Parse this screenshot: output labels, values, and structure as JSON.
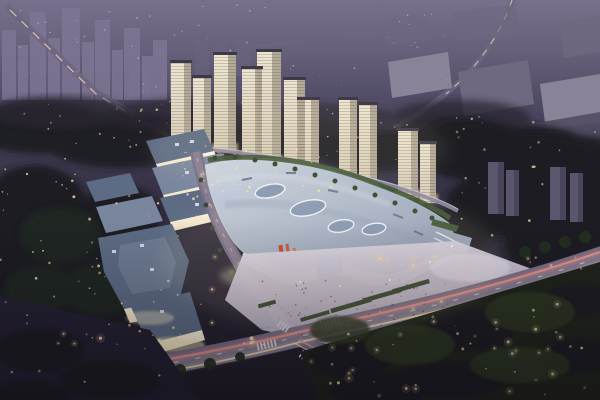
{
  "scene": {
    "description": "Aerial night-time architectural rendering of a mixed-use development: a curved-roof shopping mall with glowing facades and a blue LED media screen, a cluster of eleven illuminated residential high-rise towers behind it, low-rise street retail blocks to the west, a landscaped pedestrian plaza, and a major road intersection with car light trails, all surrounded by dark parkland, scattered warm lights and a hazy dusk city skyline.",
    "time_of_day": "dusk",
    "view": "aerial oblique",
    "lit_tower_count": 11,
    "led_screen_color": "blue"
  },
  "palette": {
    "sky_top": "#5e5873",
    "sky_mid": "#46415a",
    "ground_dark": "#2c2837",
    "ground_bottom": "#201c27",
    "haze": "#9089a6",
    "distant_building": "#7e7694",
    "distant_building_dim": "#6c6582",
    "slab": "#8a8398",
    "slab_dark": "#6e6880",
    "slab_deep": "#524c64",
    "tree_dark": "#1e1a24",
    "tree_mid": "#2a2533",
    "tree_green": "#242e20",
    "park_tree": "#2e3824",
    "lawn": "#242031",
    "park_base": "#20241c",
    "tower_lit": "#efe6d2",
    "tower_lit2": "#d8cdb7",
    "tower_shade": "#b4aa98",
    "tower_cap": "#3e3947",
    "tower_glow": "#ffe2a4",
    "dark_tower": "#5b556e",
    "dark_tower_side": "#4a455c",
    "mall_roof_light": "#cdd6e3",
    "mall_roof": "#a9b5ca",
    "mall_roof_dark": "#8795b0",
    "skylight": "#8496b2",
    "skylight_rim": "#ecf1f8",
    "fascia": "#f7f9fd",
    "facade_bright": "#fdf6e3",
    "facade_warm": "#ecdfc2",
    "glow_warm": "#f9e9c0",
    "retail_roof": "#5d6b84",
    "retail_roof_light": "#79869e",
    "roof_unit": "#cfd6e2",
    "terrace": "#95a2b8",
    "hedge": "#3d5433",
    "planter": "#35462c",
    "tree_dot": "#2f4427",
    "tree_dot_light": "#50693d",
    "led_blue": "#1d55c4",
    "led_blue_light": "#6a9af2",
    "sign_red": "#cc3d28",
    "sign_orange": "#d9772e",
    "road": "#766d86",
    "road_light": "#8f8698",
    "road_minor": "#6e6680",
    "walkway": "#8f87a0",
    "railing": "#d9d4e4",
    "trail_red": "#f0938a",
    "trail_warm": "#f8e3bd",
    "lamp": "#ffd9a0",
    "plaza_light": "#e3ddeb",
    "plaza": "#b6aec3",
    "plaza_bright": "#eae4f1",
    "people": "#433c50",
    "crosswalk": "#d8d2df",
    "window_cool": "#d8cfe8",
    "entry_white": "#ffffff"
  },
  "light_fields": [
    {
      "name": "background-tree-light",
      "layer": "lights-back",
      "x": 0,
      "y": 100,
      "w": 430,
      "h": 60,
      "n": 46,
      "r": 0.9,
      "o": 0.85,
      "color": "#e9c98f",
      "halo": false,
      "seed": 11
    },
    {
      "name": "left-forest-light",
      "layer": "lights-back",
      "x": 0,
      "y": 165,
      "w": 100,
      "h": 140,
      "n": 26,
      "r": 1.0,
      "o": 0.9,
      "color": "#f0d49a",
      "halo": false,
      "seed": 22
    },
    {
      "name": "right-trees-light",
      "layer": "lights-back",
      "x": 430,
      "y": 110,
      "w": 170,
      "h": 150,
      "n": 40,
      "r": 1.0,
      "o": 0.9,
      "color": "#eccf96",
      "halo": false,
      "seed": 33
    },
    {
      "name": "top-field-light",
      "layer": "lights-back",
      "x": 195,
      "y": 4,
      "w": 270,
      "h": 85,
      "n": 34,
      "r": 0.7,
      "o": 0.7,
      "color": "#dfd0e6",
      "halo": false,
      "seed": 44
    },
    {
      "name": "city-window-light",
      "layer": "lights-back",
      "x": 4,
      "y": 8,
      "w": 180,
      "h": 85,
      "n": 30,
      "r": 0.7,
      "o": 0.65,
      "color": "#d8cfe8",
      "halo": false,
      "seed": 55
    },
    {
      "name": "park-light",
      "layer": "lights-front",
      "x": 330,
      "y": 300,
      "w": 265,
      "h": 95,
      "n": 44,
      "r": 1.1,
      "o": 0.95,
      "color": "#f4d79c",
      "halo": true,
      "seed": 66
    },
    {
      "name": "southwest-lawn-light",
      "layer": "lights-front",
      "x": 5,
      "y": 300,
      "w": 170,
      "h": 95,
      "n": 16,
      "r": 1.0,
      "o": 0.85,
      "color": "#f0d49a",
      "halo": false,
      "seed": 77
    },
    {
      "name": "plaza-person",
      "layer": "lights-front",
      "x": 255,
      "y": 280,
      "w": 200,
      "h": 50,
      "n": 75,
      "r": 0.7,
      "o": 0.9,
      "color": "#433c50",
      "halo": false,
      "seed": 88
    },
    {
      "name": "tower-base-light",
      "layer": "lights-front",
      "x": 168,
      "y": 142,
      "w": 195,
      "h": 50,
      "n": 34,
      "r": 0.9,
      "o": 0.95,
      "color": "#ffe2a8",
      "halo": false,
      "seed": 99
    },
    {
      "name": "retail-light",
      "layer": "lights-front",
      "x": 88,
      "y": 190,
      "w": 115,
      "h": 150,
      "n": 22,
      "r": 0.9,
      "o": 0.9,
      "color": "#f6dda6",
      "halo": false,
      "seed": 100
    },
    {
      "name": "boulevard-lamp",
      "layer": "lights-front",
      "x": 30,
      "y": 332,
      "w": 250,
      "h": 12,
      "n": 11,
      "r": 1.3,
      "o": 1,
      "color": "#ffd9a0",
      "halo": true,
      "seed": 101
    },
    {
      "name": "boulevard-lamp",
      "layer": "lights-front",
      "x": 320,
      "y": 256,
      "w": 265,
      "h": 14,
      "n": 11,
      "r": 1.3,
      "o": 1,
      "color": "#ffd9a0",
      "halo": true,
      "seed": 102
    },
    {
      "name": "avenue-lamp",
      "layer": "lights-front",
      "x": 192,
      "y": 165,
      "w": 34,
      "h": 160,
      "n": 9,
      "r": 1.1,
      "o": 0.95,
      "color": "#ffd9a0",
      "halo": true,
      "seed": 103
    },
    {
      "name": "se-road-lamp",
      "layer": "lights-front",
      "x": 305,
      "y": 348,
      "w": 140,
      "h": 50,
      "n": 7,
      "r": 1.1,
      "o": 0.95,
      "color": "#ffd9a0",
      "halo": true,
      "seed": 104
    }
  ]
}
